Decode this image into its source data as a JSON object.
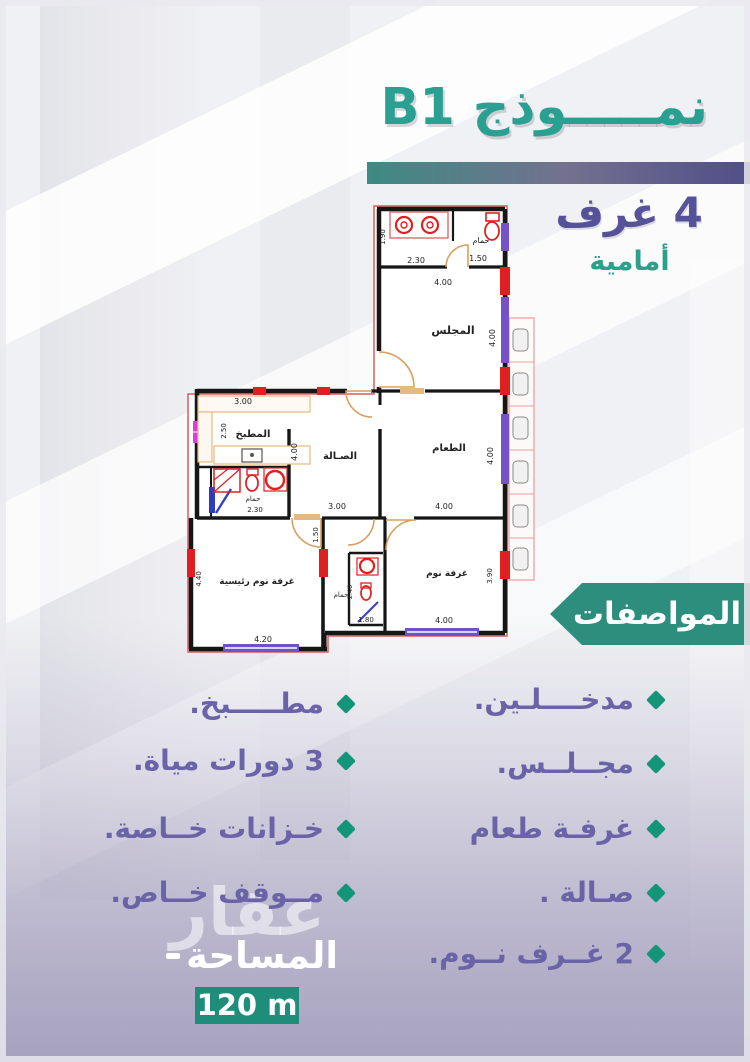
{
  "colors": {
    "title_teal": "#2aa092",
    "purple": "#55529a",
    "banner_teal": "#2e8e7d",
    "badge_teal": "#1e8d7a",
    "list_purple": "#6b63a8",
    "bullet_teal": "#14957a",
    "bar_left": "#3e8a82",
    "bar_right": "#504e87"
  },
  "header": {
    "title": "نمـــــوذج B1",
    "rooms_count": "4 غرف",
    "rooms_position": "أمامية"
  },
  "specs": {
    "banner_label": "المواصفات",
    "right_column": [
      "مدخــــلـين.",
      "مجــلــس.",
      "غرفـة طعام",
      "صـالة .",
      "2 غــرف نــوم."
    ],
    "left_column": [
      "مطـــــبخ.",
      "3 دورات مياة.",
      "خـزانات خــاصة.",
      "مــوقف خــاص."
    ]
  },
  "area": {
    "label": "المساحة",
    "value": "120 m",
    "watermark": "عقار"
  },
  "plan": {
    "bath_top": {
      "label": "حمام",
      "d1": "2.30",
      "d2": "1.50",
      "d3": "1.90"
    },
    "majlis": {
      "label": "المجلس",
      "w": "4.00",
      "h": "4.00"
    },
    "kitchen": {
      "label": "المطبخ",
      "w": "3.00",
      "h": "2.50"
    },
    "kitchen_bath": {
      "label": "حمام",
      "w": "2.30"
    },
    "hall": {
      "label": "الصـالة",
      "w": "3.00",
      "h": "4.00"
    },
    "dining": {
      "label": "الطعام",
      "w": "4.00",
      "h": "4.00"
    },
    "corridor": {
      "h": "1.50"
    },
    "master": {
      "label": "غرفة نوم رئيسية",
      "w": "4.20",
      "h": "4.40"
    },
    "bath_small": {
      "label": "حمام",
      "w": "1.80",
      "h": "2.40"
    },
    "bedroom": {
      "label": "غرفة نوم",
      "w": "4.00",
      "h": "3.90"
    }
  }
}
